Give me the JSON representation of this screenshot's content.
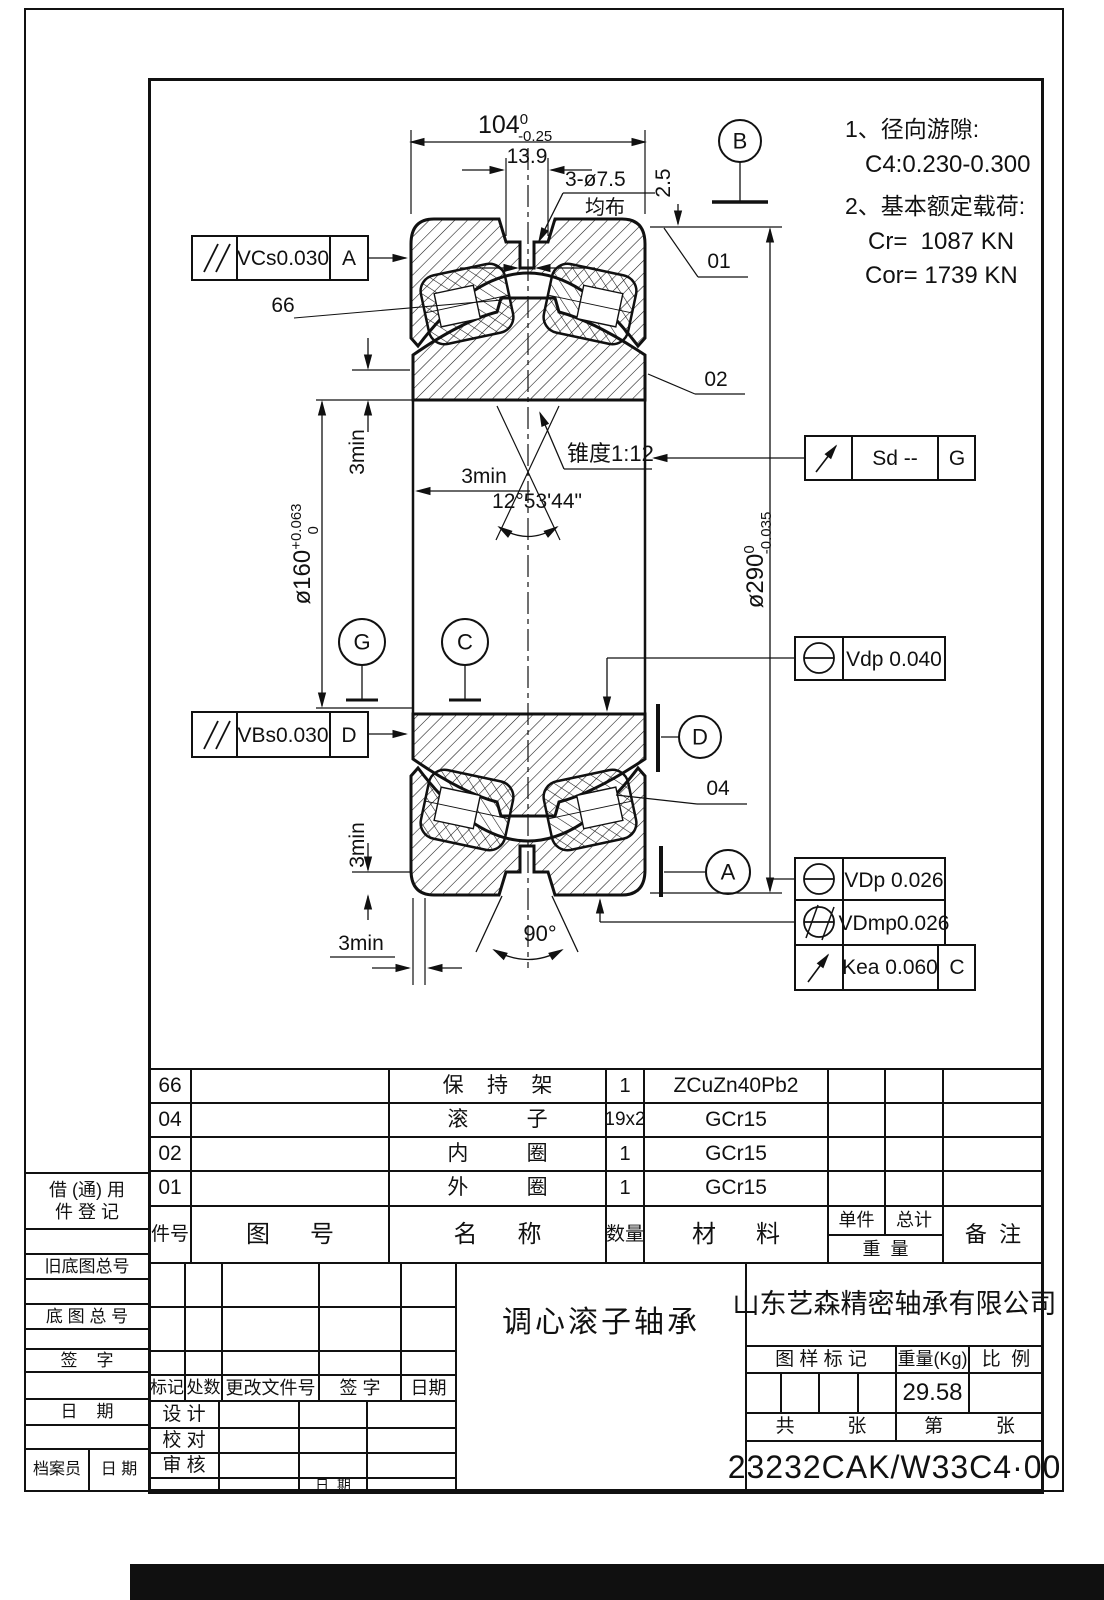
{
  "notes": {
    "l1": "1、径向游隙:",
    "l2": "C4:0.230-0.300",
    "l3": "2、基本额定载荷:",
    "l4": "Cr=  1087 KN",
    "l5": "Cor= 1739 KN"
  },
  "dims": {
    "width": "104",
    "width_sup": "0",
    "width_sub": "-0.25",
    "groove": "13.9",
    "holes": "3-ø7.5",
    "holes_note": "均布",
    "offset": "2.5",
    "od": "ø290",
    "od_sup": "0",
    "od_sub": "-0.035",
    "bore": "ø160",
    "bore_sup": "+0.063",
    "bore_sub": "0",
    "taper": "锥度1:12",
    "taper_angle": "12°53'44\"",
    "min3": "3min",
    "vee": "90°"
  },
  "labels": {
    "p01": "01",
    "p02": "02",
    "p04": "04",
    "p66": "66"
  },
  "balloons": {
    "b": "B",
    "g": "G",
    "c": "C",
    "d": "D",
    "a": "A"
  },
  "fcf": {
    "vcs": "VCs0.030",
    "vcs_datum": "A",
    "sd": "Sd --",
    "sd_datum": "G",
    "vdp": "Vdp 0.040",
    "vbs": "VBs0.030",
    "vbs_datum": "D",
    "vdp2": "VDp 0.026",
    "vdmp": "VDmp0.026",
    "kea": "Kea 0.060",
    "kea_datum": "C"
  },
  "table": {
    "rows": [
      {
        "no": "66",
        "name": "保    持    架",
        "qty": "1",
        "mat": "ZCuZn40Pb2"
      },
      {
        "no": "04",
        "name": "滚          子",
        "qty": "19x2",
        "mat": "GCr15"
      },
      {
        "no": "02",
        "name": "内          圈",
        "qty": "1",
        "mat": "GCr15"
      },
      {
        "no": "01",
        "name": "外          圈",
        "qty": "1",
        "mat": "GCr15"
      }
    ],
    "h_no": "件号",
    "h_dwg": "图      号",
    "h_name": "名      称",
    "h_qty": "数量",
    "h_mat": "材      料",
    "h_unit": "单件",
    "h_total": "总计",
    "h_weight": "重  量",
    "h_remark": "备  注"
  },
  "title": {
    "product": "调心滚子轴承",
    "company": "山东艺森精密轴承有限公司",
    "mark_label": "图 样 标 记",
    "weight_label": "重量(Kg)",
    "scale_label": "比  例",
    "weight": "29.58",
    "sheets": "共          张",
    "sheet": "第          张",
    "part_no": "23232CAK/W33C4·00",
    "rev": {
      "mark": "标记",
      "count": "处数",
      "doc": "更改文件号",
      "sign": "签 字",
      "date": "日期"
    },
    "sign": {
      "design": "设 计",
      "check": "校 对",
      "audit": "审 核",
      "date": "日  期"
    }
  },
  "left": {
    "borrow1": "借 (通) 用",
    "borrow2": "件 登 记",
    "old": "旧底图总号",
    "base": "底 图 总 号",
    "sign": "签    字",
    "date": "日    期",
    "archivist": "档案员",
    "arch_date": "日 期"
  }
}
